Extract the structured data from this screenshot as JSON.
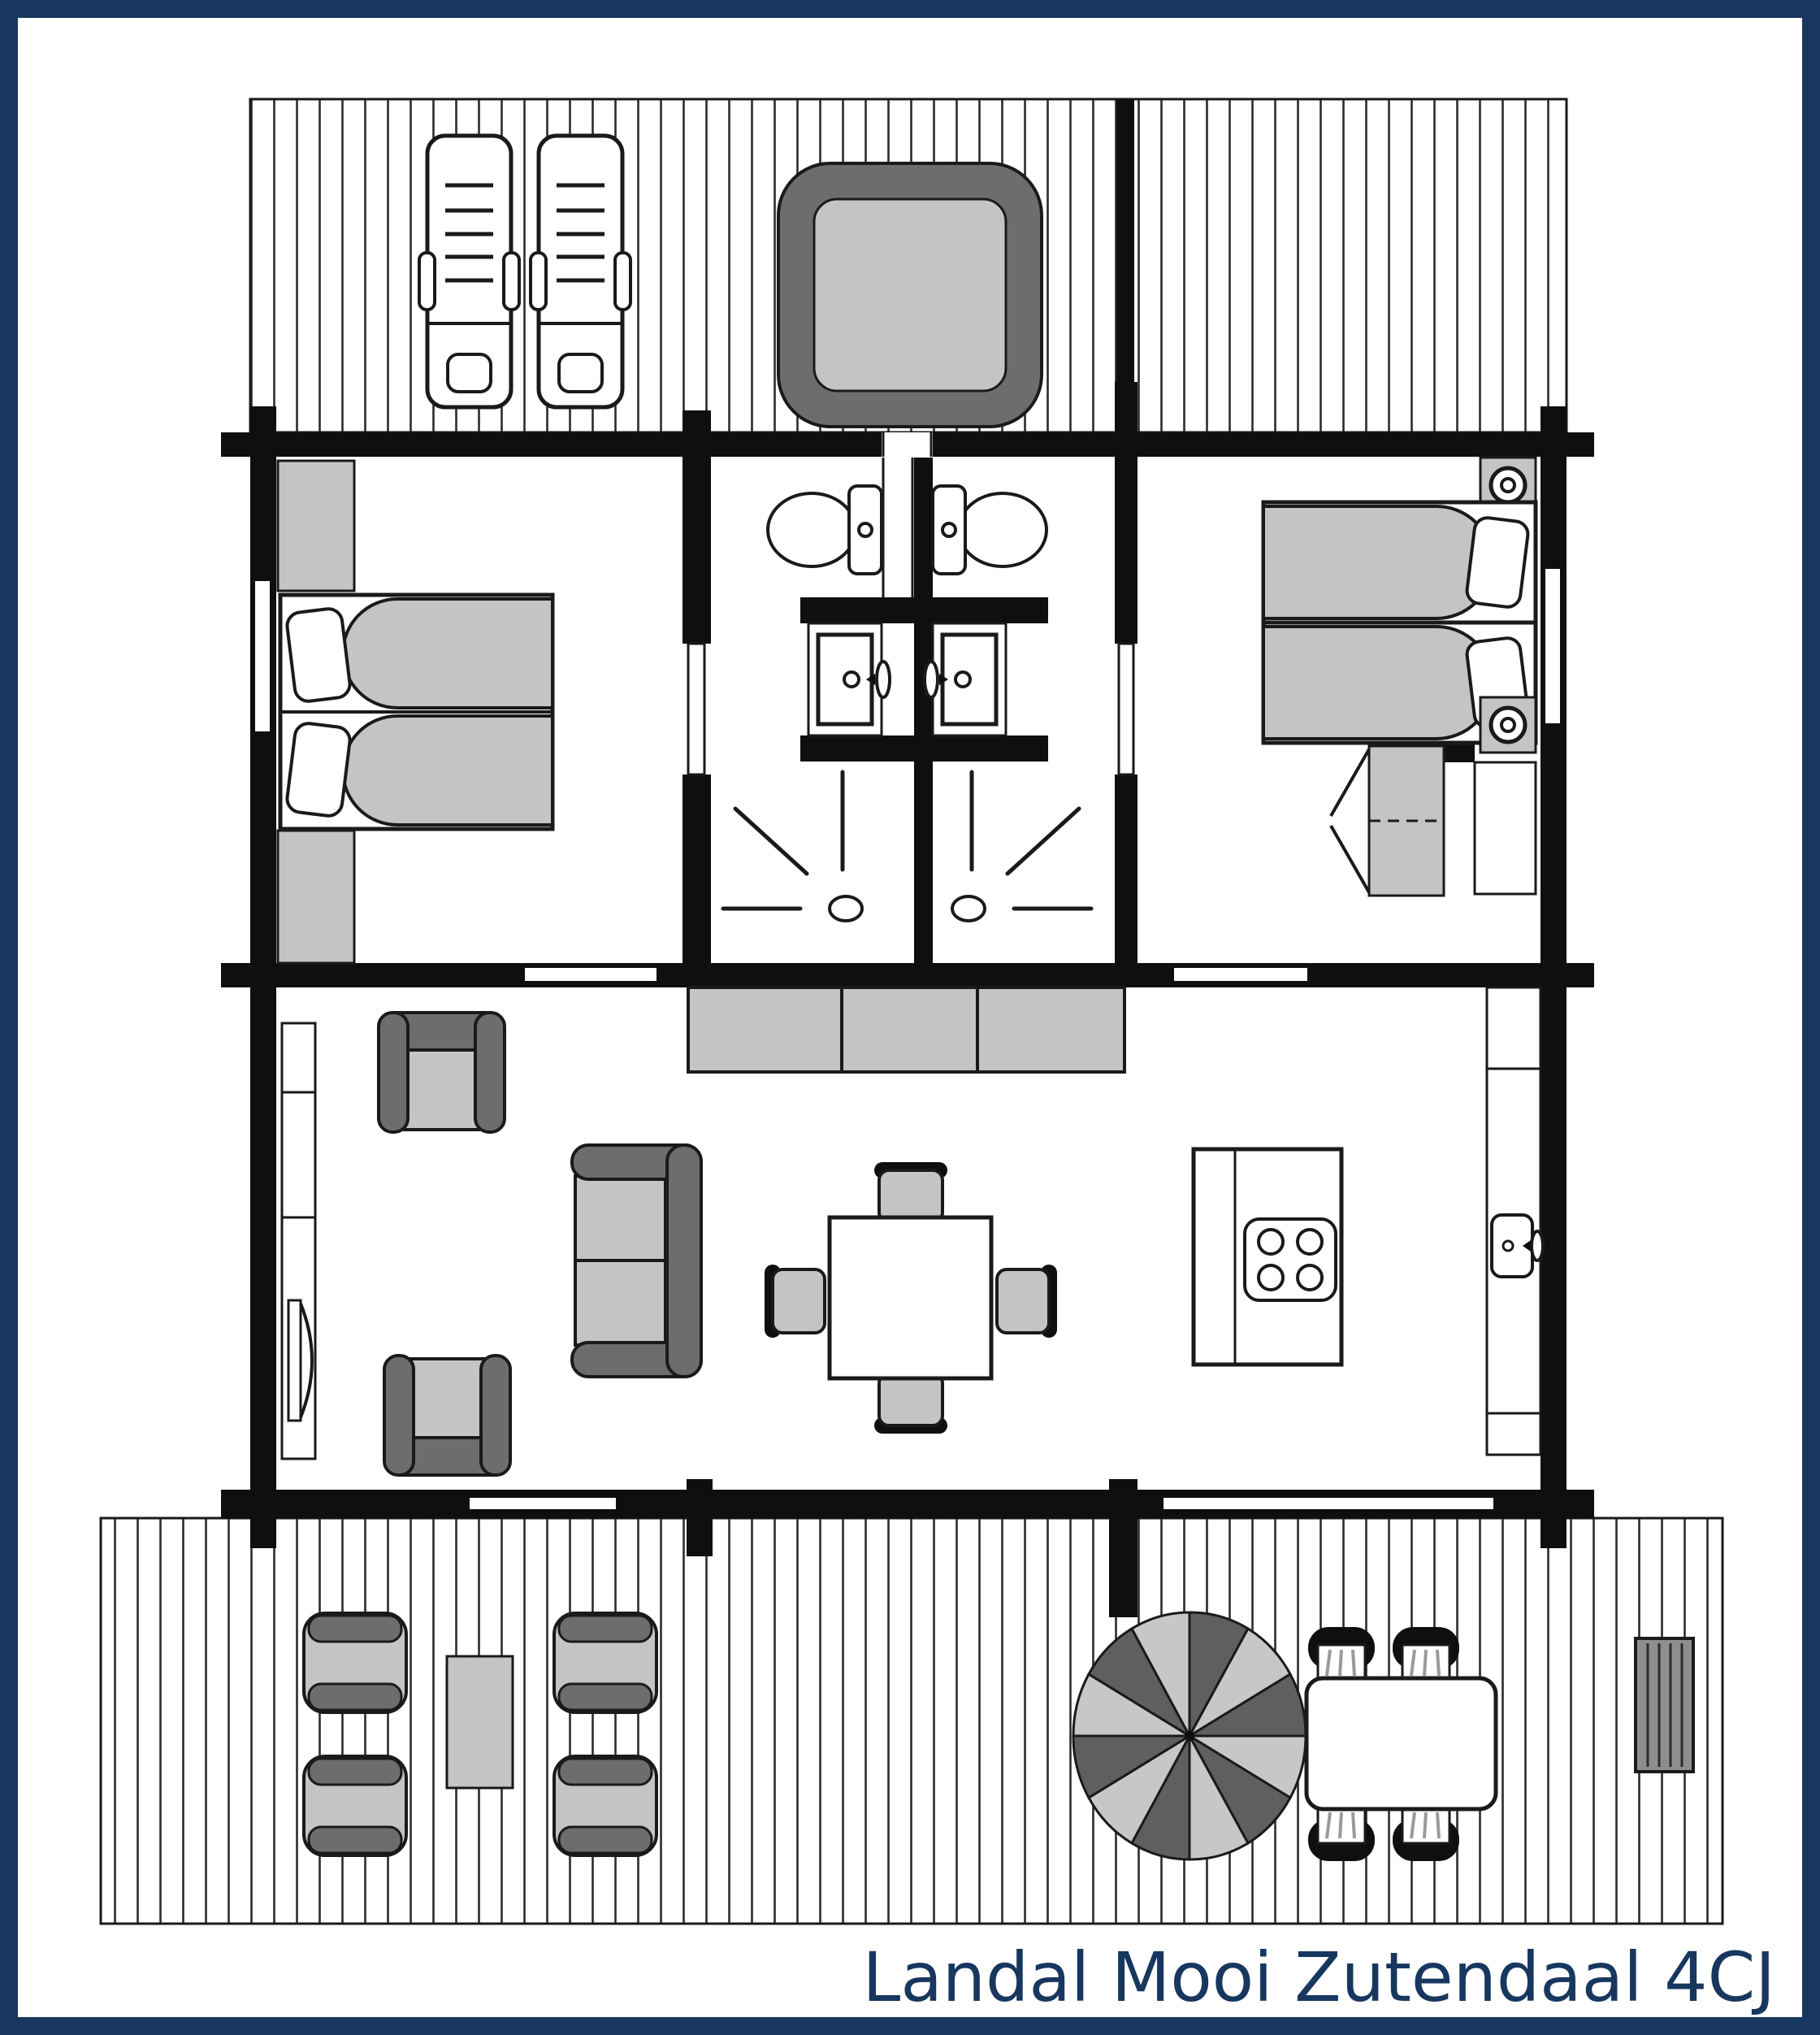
{
  "caption": {
    "text": "Landal Mooi Zutendaal 4CJ"
  },
  "colors": {
    "frame": "#17375f",
    "wall": "#0f0f0f",
    "line": "#1a1a1a",
    "light": "#c4c4c6",
    "dark": "#6d6d6f",
    "parasolDark": "#5f5f61",
    "parasolLight": "#c7c7c9",
    "bench": "#8e8e90",
    "background": "#ffffff"
  },
  "plan": {
    "type": "holiday-home-floor-plan",
    "areas": [
      {
        "name": "top-terrace",
        "furniture": [
          "sun-lounger",
          "sun-lounger",
          "hot-tub"
        ]
      },
      {
        "name": "bedroom-left",
        "furniture": [
          "wardrobe",
          "double-bed",
          "wardrobe"
        ]
      },
      {
        "name": "bathroom-left",
        "furniture": [
          "toilet",
          "washbasin",
          "shower"
        ]
      },
      {
        "name": "bathroom-right",
        "furniture": [
          "toilet",
          "washbasin",
          "shower"
        ]
      },
      {
        "name": "bedroom-right",
        "furniture": [
          "nightstand",
          "single-bed",
          "single-bed",
          "nightstand",
          "wardrobe",
          "cabinet"
        ]
      },
      {
        "name": "living-room",
        "furniture": [
          "tv-sideboard",
          "armchair",
          "armchair",
          "sofa",
          "cupboard-row",
          "dining-table",
          "dining-chair",
          "dining-chair",
          "dining-chair",
          "dining-chair"
        ]
      },
      {
        "name": "kitchen",
        "furniture": [
          "island-with-hob",
          "counter-with-sink"
        ]
      },
      {
        "name": "bottom-terrace",
        "furniture": [
          "garden-chair",
          "garden-chair",
          "garden-chair",
          "garden-chair",
          "side-table",
          "parasol",
          "garden-table",
          "garden-chair",
          "garden-chair",
          "garden-chair",
          "garden-chair",
          "bench"
        ]
      }
    ]
  }
}
